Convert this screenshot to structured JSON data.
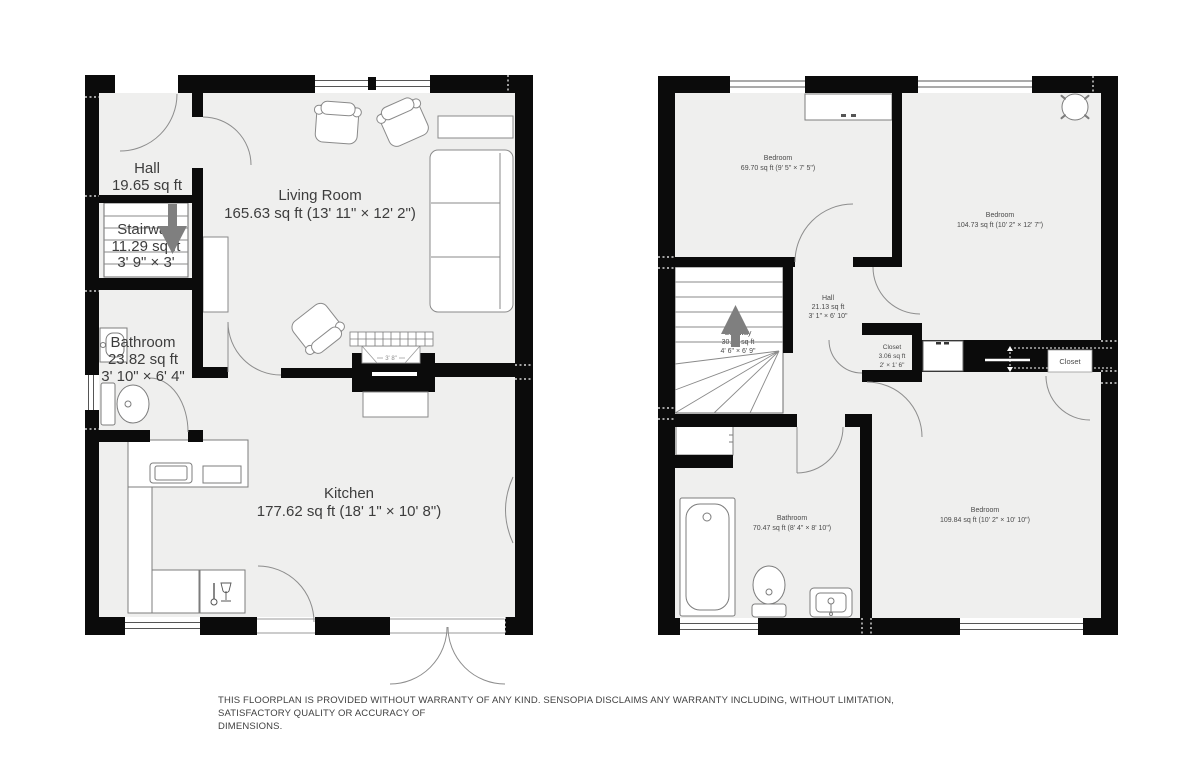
{
  "colors": {
    "wall": "#0b0b0b",
    "floor": "#efefee",
    "stair_arrow": "#7f7f7f",
    "label_dark": "#3d3d3d",
    "label_gray": "#4a4a4a"
  },
  "ground_floor": {
    "rooms": {
      "hall": {
        "name": "Hall",
        "area": "19.65 sq ft"
      },
      "stairway": {
        "name": "Stairway",
        "area": "11.29 sq ft",
        "dims": "3' 9\" × 3'"
      },
      "bathroom": {
        "name": "Bathroom",
        "area": "23.82 sq ft",
        "dims": "3' 10\" × 6' 4\""
      },
      "living_room": {
        "name": "Living Room",
        "area": "165.63 sq ft (13' 11\" × 12' 2\")"
      },
      "kitchen": {
        "name": "Kitchen",
        "area": "177.62 sq ft (18' 1\" × 10' 8\")"
      }
    },
    "fireplace_width": "3' 8\""
  },
  "upper_floor": {
    "rooms": {
      "bedroom_top_left": {
        "name": "Bedroom",
        "area": "69.70 sq ft (9' 5\" × 7' 5\")"
      },
      "bedroom_top_right": {
        "name": "Bedroom",
        "area": "104.73 sq ft (10' 2\" × 12' 7\")"
      },
      "hall": {
        "name": "Hall",
        "area": "21.13 sq ft",
        "dims": "3' 1\" × 6' 10\""
      },
      "stairway": {
        "name": "Stairway",
        "area": "30.25 sq ft",
        "dims": "4' 6\" × 6' 9\""
      },
      "closet": {
        "name": "Closet",
        "area": "3.06 sq ft",
        "dims": "2' × 1' 6\""
      },
      "closet_right": {
        "name": "Closet"
      },
      "bathroom": {
        "name": "Bathroom",
        "area": "70.47 sq ft (8' 4\" × 8' 10\")"
      },
      "bedroom_bottom": {
        "name": "Bedroom",
        "area": "109.84 sq ft (10' 2\" × 10' 10\")"
      }
    }
  },
  "disclaimer": {
    "line1": "THIS FLOORPLAN IS PROVIDED WITHOUT WARRANTY OF ANY KIND. SENSOPIA DISCLAIMS ANY WARRANTY INCLUDING, WITHOUT LIMITATION, SATISFACTORY QUALITY OR ACCURACY OF",
    "line2": "DIMENSIONS."
  }
}
